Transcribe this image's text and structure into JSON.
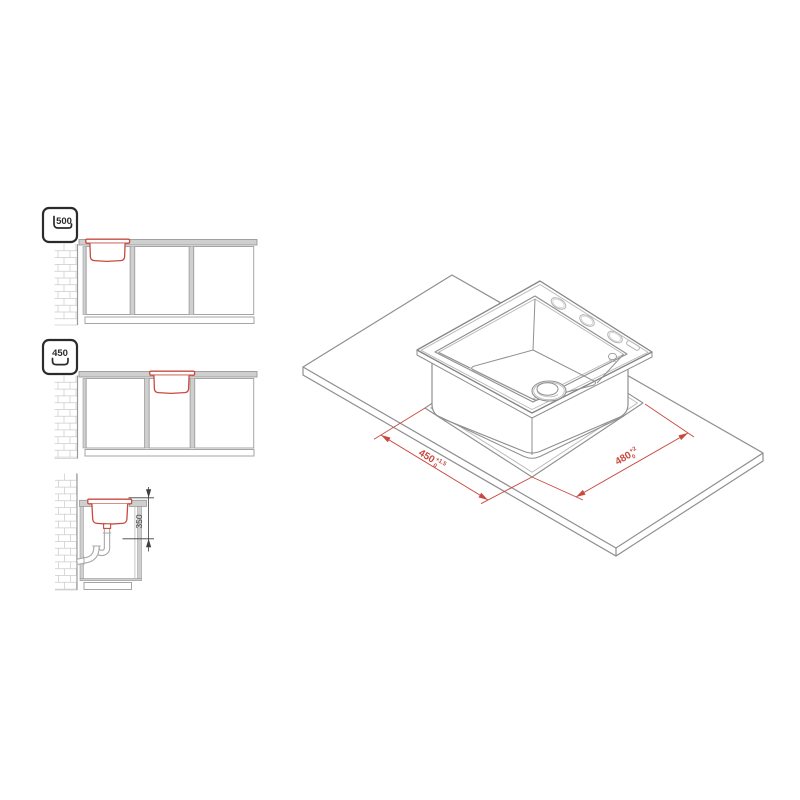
{
  "colors": {
    "red": "#c9493f",
    "gray": "#9a9a9a",
    "mid": "#8f8f8f",
    "light": "#b8b8b8",
    "fill_gray": "#cfcfcf",
    "brick": "#cccccc",
    "dim_dark": "#3f3f3f",
    "black": "#2b2b2b"
  },
  "front_view_500": {
    "badge_value": "500",
    "badge_icon": "cabinet-width-icon"
  },
  "front_view_450": {
    "badge_value": "450",
    "badge_icon": "cabinet-width-icon"
  },
  "side_section": {
    "depth_dimension": "350"
  },
  "isometric": {
    "cutout_width": {
      "value": "450",
      "tol_plus": "+1.5",
      "tol_minus": "0"
    },
    "cutout_depth": {
      "value": "480",
      "tol_plus": "+2",
      "tol_minus": "0"
    }
  }
}
